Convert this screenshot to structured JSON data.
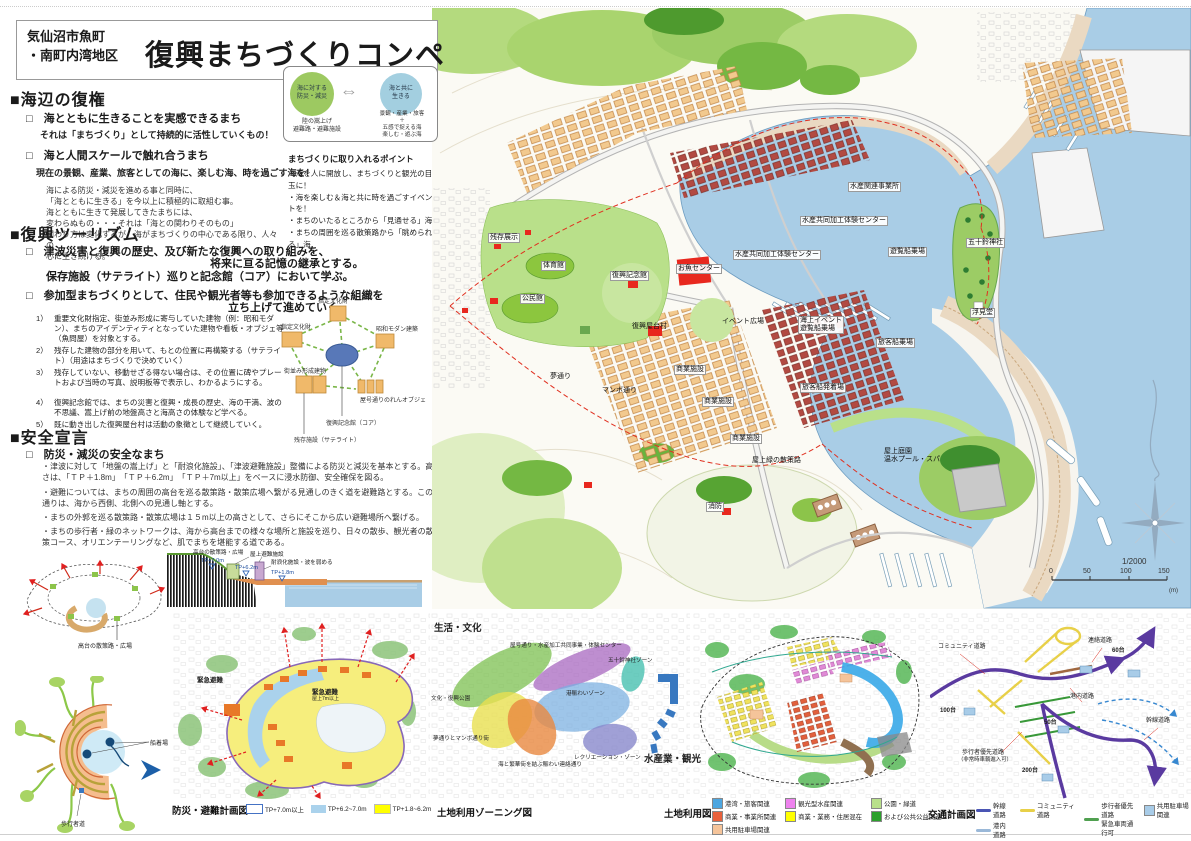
{
  "header": {
    "district_line1": "気仙沼市魚町",
    "district_line2": "・南町内湾地区",
    "title": "復興まちづくりコンペ"
  },
  "umibe": {
    "heading": "■海辺の復権",
    "check1": "□　海とともに生きることを実感できるまち",
    "check1_sub": "それは「まちづくり」として持続的に活性していくもの！",
    "check2": "□　海と人間スケールで触れ合うまち",
    "check2_sub": "現在の景観、産業、旅客としての海に、楽しむ海、時を過ごす海を！",
    "para": [
      "海による防災・減災を進める事と同時に、",
      "「海とともに生きる」を今以上に積極的に取組む事。",
      "海とともに生きて発展してきたまちには、",
      "変わらぬもの・・・それは「海との関わりそのもの」",
      "関わり方は変化するが、海がまちづくりの中心である限り、人々の",
      "心に生き続ける。"
    ],
    "points_title": "まちづくりに取り入れるポイント",
    "points": [
      "・海を人に開放し、まちづくりと観光の目玉に！",
      "・海を楽しむ＆海と共に時を過ごすイベントを！",
      "・まちのいたるところから「見通せる」海",
      "・まちの周囲を巡る散策路から「眺められる」海"
    ],
    "venn": {
      "left_line1": "海に対する",
      "left_line2": "防災・減災",
      "right_line1": "海と共に",
      "right_line2": "生きる",
      "arrow": "⇔",
      "left_cap": [
        "陸の嵩上げ",
        "避難路・避難施設"
      ],
      "right_cap": [
        "景観・産業・旅客",
        "＋",
        "五感で捉える海",
        "楽しむ・遊ぶ海"
      ]
    }
  },
  "tourism": {
    "heading": "■復興ツーリズム",
    "check1_l1": "□　津波災害と復興の歴史、及び新たな復興への取り組みを、",
    "check1_l2": "将来に亘る記憶の継承とする。",
    "check1_l3": "保存施設（サテライト）巡りと記念館（コア）において学ぶ。",
    "check2_l1": "□　参加型まちづくりとして、住民や観光者等も参加できるような組織を",
    "check2_l2": "立ち上げて進めていく。",
    "list": [
      {
        "num": "1）",
        "text": "重要文化財指定、街並み形成に寄与していた建物（例：昭和モダン）、まちのアイデンティティとなっていた建物や看板・オブジェ等（魚問屋）を対象とする。"
      },
      {
        "num": "2）",
        "text": "残存した建物の部分を用いて、もとの位置に再構築する（サテライト）（用途はまちづくりで決めていく）"
      },
      {
        "num": "3）",
        "text": "残存していない、移動せざる得ない場合は、その位置に碑やプレートおよび当時の写真、説明板等で表示し、わかるようにする。"
      },
      {
        "num": "4）",
        "text": "復興記念館では、まちの災害と復興・成長の歴史、海の干満、波の不思議、嵩上げ前の地盤高さと海高さの体験など学べる。"
      },
      {
        "num": "5）",
        "text": "既に動き出した復興屋台村は活動の象徴として継続していく。"
      }
    ],
    "pentagon": {
      "top": "指定文化財",
      "left": "指定文化財",
      "right": "昭和モダン建築",
      "bottom_left": "街並み形成建物",
      "bottom_right": "屋号通りのれんオブジェ",
      "core": "復興記念館（コア）",
      "satellite": "残存施設（サテライト）"
    }
  },
  "safety": {
    "heading": "■安全宣言",
    "check1": "□　防災・減災の安全なまち",
    "bullets": [
      "・津波に対して「地盤の嵩上げ」と「耐浪化施設」、「津波避難施設」整備による防災と減災を基本とする。高さは、「ＴＰ＋1.8m」　「ＴＰ＋6.2m」　「ＴＰ＋7m以上」をベースに浸水防御、安全確保を図る。",
      "・避難については、まちの周囲の高台を巡る散策路・散策広場へ繋がる見通しのきく道を避難路とする。この通りは、海から西側、北側への見通し軸とする。",
      "・まちの外郭を巡る散策路・散策広場は１５m以上の高さとして、さらにそこから広い避難場所へ繋げる。",
      "・まちの歩行者・緑のネットワークは、海から高台までの様々な場所と施設を巡り、日々の散歩、観光者の散策コース、オリエンテーリングなど、肌でまちを堪能する道である。"
    ]
  },
  "xsection": {
    "path_label": "高台の散策路・広場",
    "rooftop_label": "屋上避難施設",
    "wave_label": "耐浪化施設・波を弱める",
    "tp7": "TP+7.0m",
    "tp62": "TP+6.2m",
    "tp18": "TP+1.8m"
  },
  "radial": {
    "label": "高台の散策路・広場"
  },
  "ring": {
    "boat": "船着場",
    "walker": "歩行者道"
  },
  "main_map": {
    "labels": {
      "zanzon": "残存展示",
      "taiikukan": "体育館",
      "kouminkan": "公民館",
      "kinenkan": "復興記念館",
      "osakana": "お魚センター",
      "event_hiroba": "イベント広場",
      "yataimura": "復興屋台村",
      "suisan_office": "水産関連事業所",
      "kako1": "水産共同加工体験センター",
      "kako2": "水産共同加工体験センター",
      "yuransen": "遊覧船乗場",
      "isuzu": "五十鈴神社",
      "ukimido": "浮見堂",
      "kaijo1": "海上イベント",
      "kaijo2": "遊覧船乗場",
      "ryokaku": "旅客船乗場",
      "hatchaku": "旅客船発着場",
      "manbo": "マンボ通り",
      "yume": "夢通り",
      "shogyo": "商業施設",
      "okujo_midori": "屋上緑の散策路",
      "teien1": "屋上庭園",
      "teien2": "温水プール・スパ",
      "shobo": "消防"
    },
    "scale": {
      "ratio": "1/2000",
      "t0": "0",
      "t50": "50",
      "t100": "100",
      "t150": "150",
      "unit": "(m)"
    }
  },
  "panels": {
    "bousai": {
      "caption": "防災・避難計画図",
      "legend": [
        {
          "label": "TP+7.0m以上",
          "color": "#ffffff",
          "border": "#4472c4"
        },
        {
          "label": "TP+6.2~7.0m",
          "color": "#aad2ec"
        },
        {
          "label": "TP+1.8~6.2m",
          "color": "#ffff00"
        }
      ],
      "label_left": "緊急避難",
      "label_c1": "緊急避難",
      "label_c2": "屋上7m以上"
    },
    "zoning": {
      "caption": "土地利用ゾーニング図",
      "big_left": "生活・文化",
      "big_right": "水産業・観光",
      "z_yago": "屋号通り・水産加工共同事業・体験センター",
      "z_isuzu": "五十鈴神社ゾーン",
      "z_minato": "港賑わいゾーン",
      "z_bunka": "文化・復興公園",
      "z_yume": "夢通りとマンボ通り街",
      "z_umi": "海と繁華街を結ぶ賑わい連絡通り",
      "z_recreation": "レクリエーション・ゾーン"
    },
    "landuse": {
      "caption": "土地利用図",
      "legend": [
        {
          "label": "港湾・旅客関連",
          "color": "#4da6e0"
        },
        {
          "label": "商業・事業所関連",
          "color": "#e8613c"
        },
        {
          "label": "共用駐車場関連",
          "color": "#f5c49a"
        },
        {
          "label": "観光型水産関連",
          "color": "#ee82ee"
        },
        {
          "label": "商業・業務・住居混在",
          "color": "#ffff00"
        },
        {
          "label": "公園・緑道",
          "color": "#b8e08a"
        },
        {
          "label": "および公共公益関連",
          "color": "#2ca02c"
        }
      ]
    },
    "traffic": {
      "caption": "交通計画図",
      "legend": [
        {
          "label": "幹線道路",
          "color": "#4a55b4"
        },
        {
          "label": "港内道路",
          "color": "#9ab8d8"
        },
        {
          "label": "コミュニティ道路",
          "color": "#e8d048"
        },
        {
          "label": "歩行者優先道路",
          "label2": "緊急車両通行可",
          "color": "#50a050"
        },
        {
          "label": "共用駐車場関連",
          "color": "#a8cce8"
        }
      ],
      "roads": {
        "community": "コミュニティ道路",
        "renraku": "連絡道路",
        "konai": "港内道路",
        "kansen": "幹線道路",
        "hokosha1": "歩行者優先道路",
        "hokosha2": "（非常時車輌進入可）"
      },
      "parking": {
        "p100": "100台",
        "p60": "60台",
        "p50": "50台",
        "p200": "200台"
      }
    }
  },
  "colors": {
    "sea": "#a9cde6",
    "hill_green": "#8fc642",
    "building_orange": "#f2c98e",
    "waterfront_red": "#b24a42",
    "landmark_red": "#e8281e",
    "evacuation_red": "#e02020",
    "zone_yellow": "#f6ee7d",
    "tp62_blue": "#aad2ec",
    "trunk_purple": "#5a3aa0"
  }
}
